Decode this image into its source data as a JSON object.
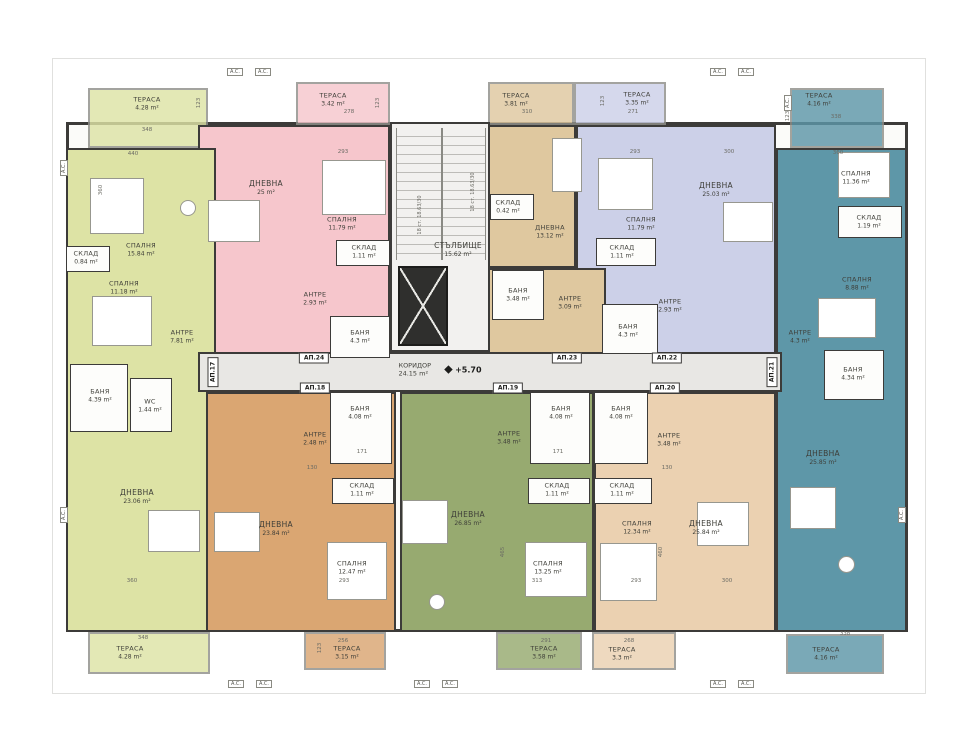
{
  "meta": {
    "level": "+5.70"
  },
  "common": {
    "corridor": {
      "name": "КОРИДОР",
      "area": "24.15 m²"
    },
    "staircase": {
      "name": "СТЪЛБИЩЕ",
      "area": "15.62 m²"
    },
    "stair_note": "18 ст. 18.63/30",
    "ac_label": "A.C."
  },
  "colors": {
    "a17": "#dde3a5",
    "a18": "#daa672",
    "a19": "#97aa70",
    "a20": "#ebd1b1",
    "a21": "#5e97a8",
    "a22": "#ccd0e8",
    "a23": "#dfc89f",
    "a24": "#f6c6cc",
    "corridor": "#e8e7e4"
  },
  "badges": {
    "a17": "АП.17",
    "a18": "АП.18",
    "a19": "АП.19",
    "a20": "АП.20",
    "a21": "АП.21",
    "a22": "АП.22",
    "a23": "АП.23",
    "a24": "АП.24"
  },
  "rooms": {
    "a17_terrace_top": {
      "name": "ТЕРАСА",
      "area": "4.28 m²"
    },
    "a17_bedroom1": {
      "name": "СПАЛНЯ",
      "area": "15.84 m²"
    },
    "a17_sklad": {
      "name": "СКЛАД",
      "area": "0.84 m²"
    },
    "a17_bedroom2": {
      "name": "СПАЛНЯ",
      "area": "11.18 m²"
    },
    "a17_antre": {
      "name": "АНТРЕ",
      "area": "7.81 m²"
    },
    "a17_bath": {
      "name": "БАНЯ",
      "area": "4.39 m²"
    },
    "a17_wc": {
      "name": "WC",
      "area": "1.44 m²"
    },
    "a17_living": {
      "name": "ДНЕВНА",
      "area": "23.06 m²"
    },
    "a17_terrace_bottom": {
      "name": "ТЕРАСА",
      "area": "4.28 m²"
    },
    "a24_terrace": {
      "name": "ТЕРАСА",
      "area": "3.42 m²"
    },
    "a24_living": {
      "name": "ДНЕВНА",
      "area": "25 m²"
    },
    "a24_bedroom": {
      "name": "СПАЛНЯ",
      "area": "11.79 m²"
    },
    "a24_sklad": {
      "name": "СКЛАД",
      "area": "1.11 m²"
    },
    "a24_antre": {
      "name": "АНТРЕ",
      "area": "2.93 m²"
    },
    "a24_bath": {
      "name": "БАНЯ",
      "area": "4.3 m²"
    },
    "a23_terrace": {
      "name": "ТЕРАСА",
      "area": "3.81 m²"
    },
    "a23_living": {
      "name": "ДНЕВНА",
      "area": "13.12 m²"
    },
    "a23_sklad": {
      "name": "СКЛАД",
      "area": "0.42 m²"
    },
    "a23_bath": {
      "name": "БАНЯ",
      "area": "3.48 m²"
    },
    "a23_antre": {
      "name": "АНТРЕ",
      "area": "3.09 m²"
    },
    "a22_terrace": {
      "name": "ТЕРАСА",
      "area": "3.35 m²"
    },
    "a22_bedroom": {
      "name": "СПАЛНЯ",
      "area": "11.79 m²"
    },
    "a22_living": {
      "name": "ДНЕВНА",
      "area": "25.03 m²"
    },
    "a22_sklad": {
      "name": "СКЛАД",
      "area": "1.11 m²"
    },
    "a22_antre": {
      "name": "АНТРЕ",
      "area": "2.93 m²"
    },
    "a22_bath": {
      "name": "БАНЯ",
      "area": "4.3 m²"
    },
    "a21_terrace_top": {
      "name": "ТЕРАСА",
      "area": "4.16 m²"
    },
    "a21_bedroom1": {
      "name": "СПАЛНЯ",
      "area": "11.36 m²"
    },
    "a21_sklad": {
      "name": "СКЛАД",
      "area": "1.19 m²"
    },
    "a21_bedroom2": {
      "name": "СПАЛНЯ",
      "area": "8.88 m²"
    },
    "a21_antre": {
      "name": "АНТРЕ",
      "area": "4.3 m²"
    },
    "a21_bath": {
      "name": "БАНЯ",
      "area": "4.34 m²"
    },
    "a21_living": {
      "name": "ДНЕВНА",
      "area": "25.85 m²"
    },
    "a21_terrace_bottom": {
      "name": "ТЕРАСА",
      "area": "4.16 m²"
    },
    "a18_bath": {
      "name": "БАНЯ",
      "area": "4.08 m²"
    },
    "a18_antre": {
      "name": "АНТРЕ",
      "area": "2.48 m²"
    },
    "a18_sklad": {
      "name": "СКЛАД",
      "area": "1.11 m²"
    },
    "a18_living": {
      "name": "ДНЕВНА",
      "area": "23.84 m²"
    },
    "a18_bedroom": {
      "name": "СПАЛНЯ",
      "area": "12.47 m²"
    },
    "a18_terrace": {
      "name": "ТЕРАСА",
      "area": "3.15 m²"
    },
    "a19_antre": {
      "name": "АНТРЕ",
      "area": "3.48 m²"
    },
    "a19_bath": {
      "name": "БАНЯ",
      "area": "4.08 m²"
    },
    "a19_sklad": {
      "name": "СКЛАД",
      "area": "1.11 m²"
    },
    "a19_living": {
      "name": "ДНЕВНА",
      "area": "26.85 m²"
    },
    "a19_bedroom": {
      "name": "СПАЛНЯ",
      "area": "13.25 m²"
    },
    "a19_terrace": {
      "name": "ТЕРАСА",
      "area": "3.58 m²"
    },
    "a20_bath": {
      "name": "БАНЯ",
      "area": "4.08 m²"
    },
    "a20_antre": {
      "name": "АНТРЕ",
      "area": "3.48 m²"
    },
    "a20_sklad": {
      "name": "СКЛАД",
      "area": "1.11 m²"
    },
    "a20_bedroom": {
      "name": "СПАЛНЯ",
      "area": "12.34 m²"
    },
    "a20_living": {
      "name": "ДНЕВНА",
      "area": "25.84 m²"
    },
    "a20_terrace": {
      "name": "ТЕРАСА",
      "area": "3.3 m²"
    }
  },
  "dimensions": [
    {
      "t": "348",
      "x": 147,
      "y": 130
    },
    {
      "t": "123",
      "x": 199,
      "y": 103,
      "v": true
    },
    {
      "t": "440",
      "x": 133,
      "y": 154
    },
    {
      "t": "360",
      "x": 101,
      "y": 190,
      "v": true
    },
    {
      "t": "278",
      "x": 349,
      "y": 112
    },
    {
      "t": "123",
      "x": 378,
      "y": 103,
      "v": true
    },
    {
      "t": "293",
      "x": 343,
      "y": 152
    },
    {
      "t": "310",
      "x": 527,
      "y": 112
    },
    {
      "t": "123",
      "x": 603,
      "y": 101,
      "v": true
    },
    {
      "t": "271",
      "x": 633,
      "y": 112
    },
    {
      "t": "293",
      "x": 635,
      "y": 152
    },
    {
      "t": "300",
      "x": 729,
      "y": 152
    },
    {
      "t": "338",
      "x": 836,
      "y": 117
    },
    {
      "t": "123",
      "x": 788,
      "y": 116,
      "v": true
    },
    {
      "t": "360",
      "x": 838,
      "y": 153
    },
    {
      "t": "171",
      "x": 362,
      "y": 452
    },
    {
      "t": "171",
      "x": 558,
      "y": 452
    },
    {
      "t": "130",
      "x": 312,
      "y": 468
    },
    {
      "t": "130",
      "x": 667,
      "y": 468
    },
    {
      "t": "465",
      "x": 503,
      "y": 552,
      "v": true
    },
    {
      "t": "460",
      "x": 661,
      "y": 552,
      "v": true
    },
    {
      "t": "360",
      "x": 132,
      "y": 581
    },
    {
      "t": "313",
      "x": 537,
      "y": 581
    },
    {
      "t": "293",
      "x": 344,
      "y": 581
    },
    {
      "t": "293",
      "x": 636,
      "y": 581
    },
    {
      "t": "300",
      "x": 727,
      "y": 581
    },
    {
      "t": "348",
      "x": 143,
      "y": 638
    },
    {
      "t": "256",
      "x": 343,
      "y": 641
    },
    {
      "t": "291",
      "x": 546,
      "y": 641
    },
    {
      "t": "268",
      "x": 629,
      "y": 641
    },
    {
      "t": "338",
      "x": 845,
      "y": 634
    },
    {
      "t": "123",
      "x": 320,
      "y": 648,
      "v": true
    }
  ],
  "ac_units": [
    {
      "x": 235,
      "y": 72
    },
    {
      "x": 263,
      "y": 72
    },
    {
      "x": 718,
      "y": 72
    },
    {
      "x": 746,
      "y": 72
    },
    {
      "x": 236,
      "y": 684
    },
    {
      "x": 264,
      "y": 684
    },
    {
      "x": 422,
      "y": 684
    },
    {
      "x": 450,
      "y": 684
    },
    {
      "x": 718,
      "y": 684
    },
    {
      "x": 746,
      "y": 684
    },
    {
      "x": 64,
      "y": 168,
      "v": true
    },
    {
      "x": 64,
      "y": 515,
      "v": true
    },
    {
      "x": 902,
      "y": 515,
      "v": true
    },
    {
      "x": 788,
      "y": 103,
      "v": true
    }
  ]
}
